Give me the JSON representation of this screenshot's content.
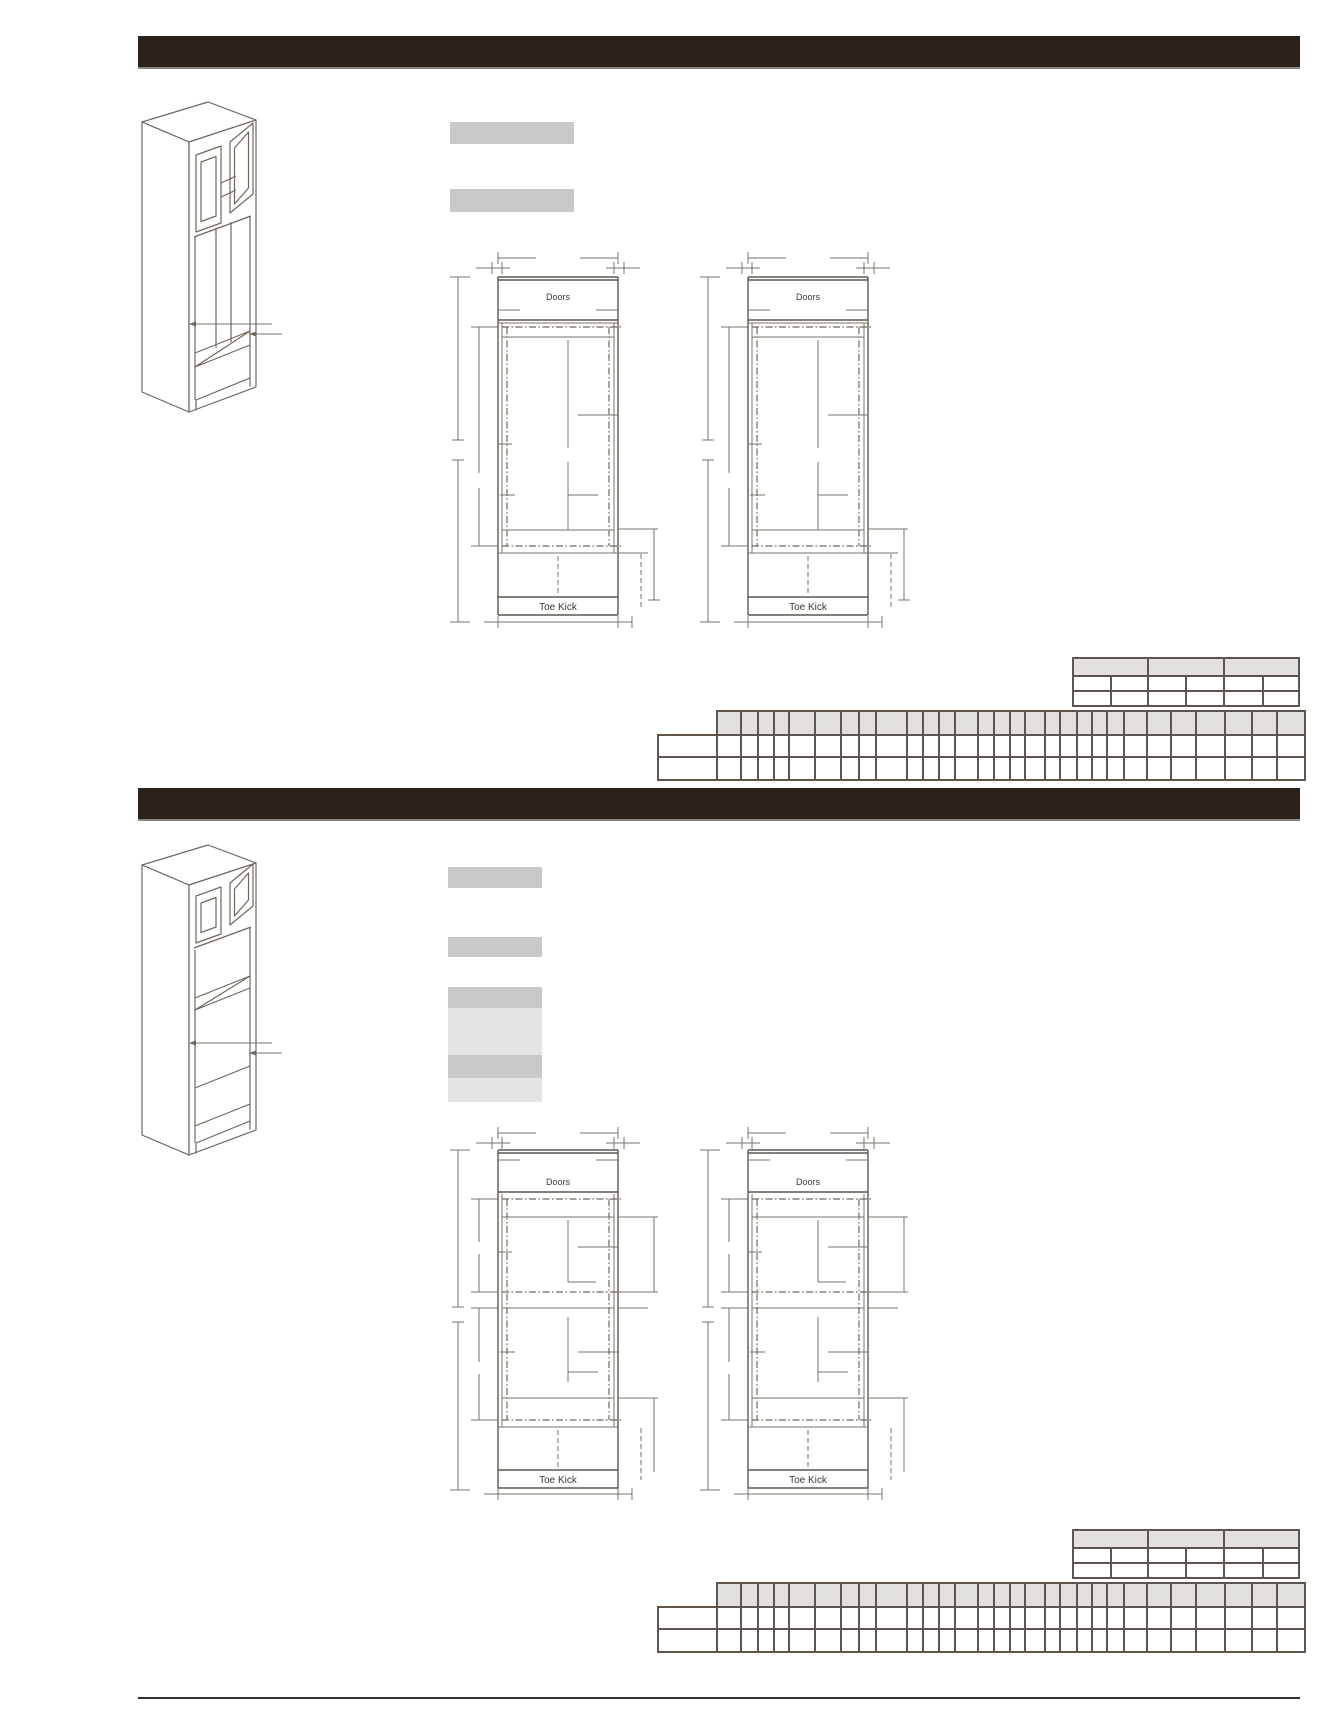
{
  "labels": {
    "doors": "Doors",
    "toe_kick": "Toe Kick"
  },
  "colors": {
    "title_bar": "#2b2219",
    "line_work": "#6f675d",
    "redacted_box": "#c9c9c9",
    "redacted_box_light": "#e4e4e4",
    "table_header_fill": "#e3e1de",
    "table_border": "#5e564d",
    "page_background": "#ffffff"
  },
  "tables": {
    "small": {
      "width": 226,
      "height": 48,
      "col_pos": {
        "header": [
          0,
          75,
          151,
          226
        ],
        "body": [
          0,
          38,
          75,
          113,
          151,
          190,
          226
        ]
      },
      "rows": [
        {
          "y": 0,
          "h": 18,
          "cols": "header",
          "fill": "header"
        },
        {
          "y": 18,
          "h": 15,
          "cols": "body",
          "fill": "body"
        },
        {
          "y": 33,
          "h": 15,
          "cols": "body",
          "fill": "body"
        }
      ]
    },
    "large": {
      "width": 647,
      "height": 69,
      "col_pos": {
        "header": [
          59,
          83,
          100,
          116,
          131,
          157,
          183,
          201,
          218,
          249,
          265,
          281,
          297,
          320,
          336,
          352,
          367,
          387,
          402,
          419,
          434,
          449,
          466,
          489,
          513,
          538,
          567,
          594,
          619,
          647
        ],
        "body": [
          0,
          59,
          83,
          100,
          116,
          131,
          157,
          183,
          201,
          218,
          249,
          265,
          281,
          297,
          320,
          336,
          352,
          367,
          387,
          402,
          419,
          434,
          449,
          466,
          489,
          513,
          538,
          567,
          594,
          619,
          647
        ]
      },
      "rows": [
        {
          "y": 0,
          "h": 24,
          "cols": "header",
          "fill": "header"
        },
        {
          "y": 24,
          "h": 22,
          "cols": "body",
          "fill": "body"
        },
        {
          "y": 46,
          "h": 23,
          "cols": "body",
          "fill": "body"
        }
      ]
    }
  }
}
